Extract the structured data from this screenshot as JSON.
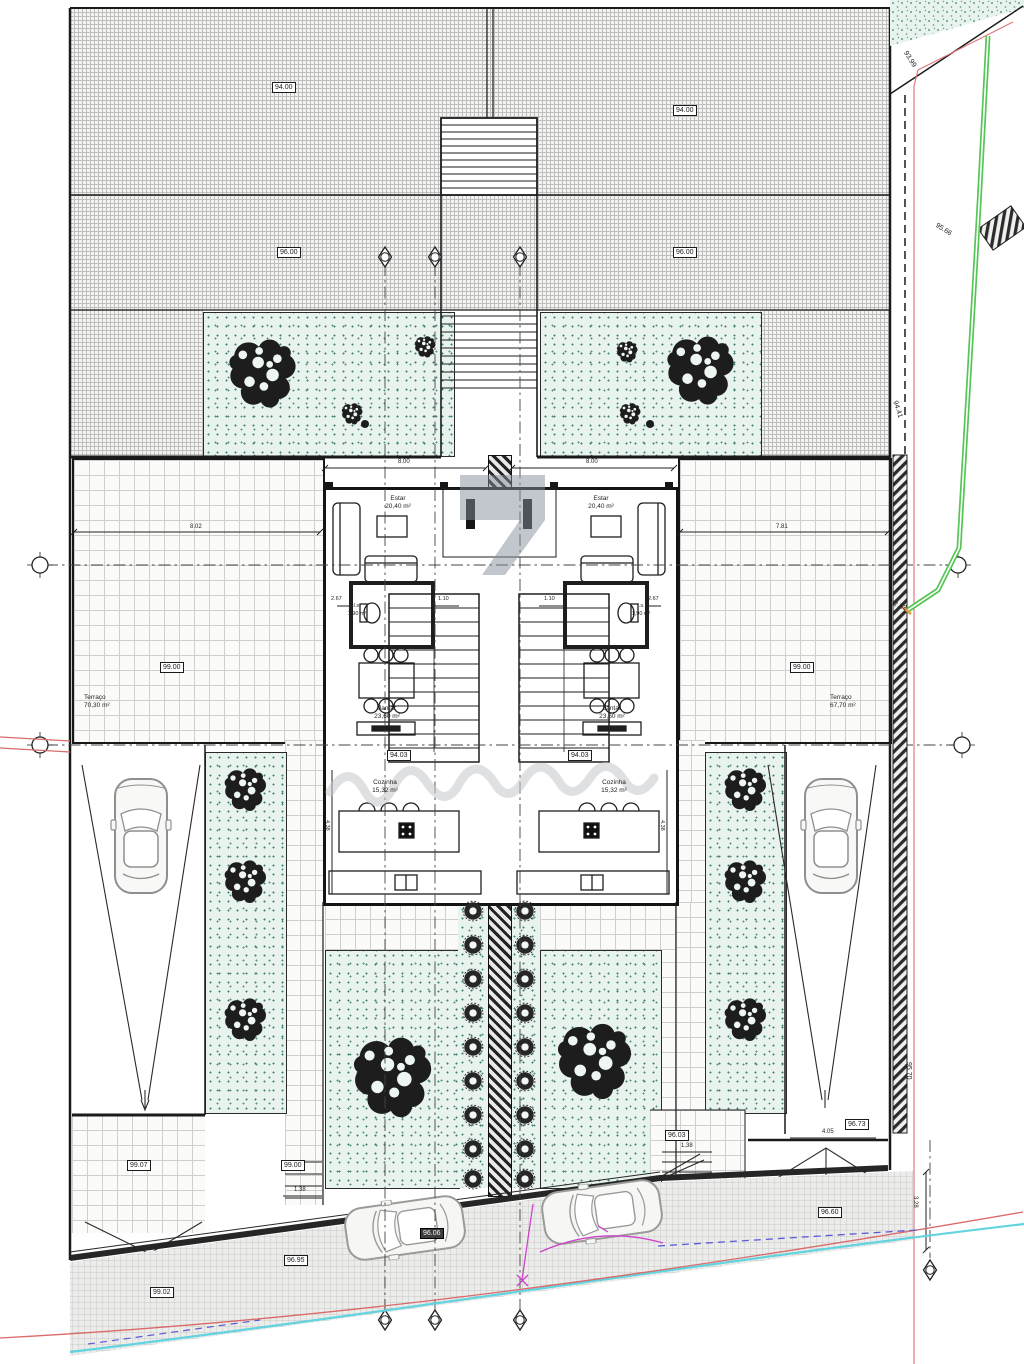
{
  "drawing_type": "architectural site plan - ground floor, semi-detached houses",
  "levels": {
    "roof": "94.00",
    "upper": "96.00",
    "terrace": "99.00",
    "floor": "94.03",
    "drive_left": "99.07",
    "walk_left": "99.00",
    "walk_mid": "96.95",
    "walk_low": "99.02",
    "street_mid": "96.06",
    "entry_right": "96.03",
    "drive_right": "96.73",
    "street_right": "96.60"
  },
  "boundary_levels": {
    "b1": "93.99",
    "b2": "94.41",
    "b3": "95.66",
    "b4": "97.52",
    "b5": "95.70"
  },
  "rooms": {
    "estar": {
      "name": "Estar",
      "area": "20,40 m²"
    },
    "jantar": {
      "name": "Jantar",
      "area": "23,60 m²"
    },
    "cozinha": {
      "name": "Cozinha",
      "area": "15,32 m²"
    },
    "wc": {
      "name": "I.s.",
      "area": "1,90 m²"
    },
    "terraco_left": {
      "name": "Terraço",
      "area": "70,30 m²"
    },
    "terraco_right": {
      "name": "Terraço",
      "area": "67,70 m²"
    }
  },
  "dims": {
    "unit_w": "8.00",
    "terr_left_w": "8.02",
    "terr_right_w": "7.81",
    "wc_w": "2.67",
    "wc_gap": "1.10",
    "stair_w": "1.38",
    "ramp_right": "4.05",
    "side_v": "3.28",
    "kitchen_d": "4.38"
  },
  "colors": {
    "wall": "#1c1c1c",
    "garden": "#e7f3ec",
    "boundary_red": "#d96a6a",
    "parcel_pink": "#e07878",
    "boundary_green": "#55c555",
    "curb_cyan": "#62d4e0",
    "utility_magenta": "#cc44cc",
    "dash_blue": "#5b5bd6"
  }
}
